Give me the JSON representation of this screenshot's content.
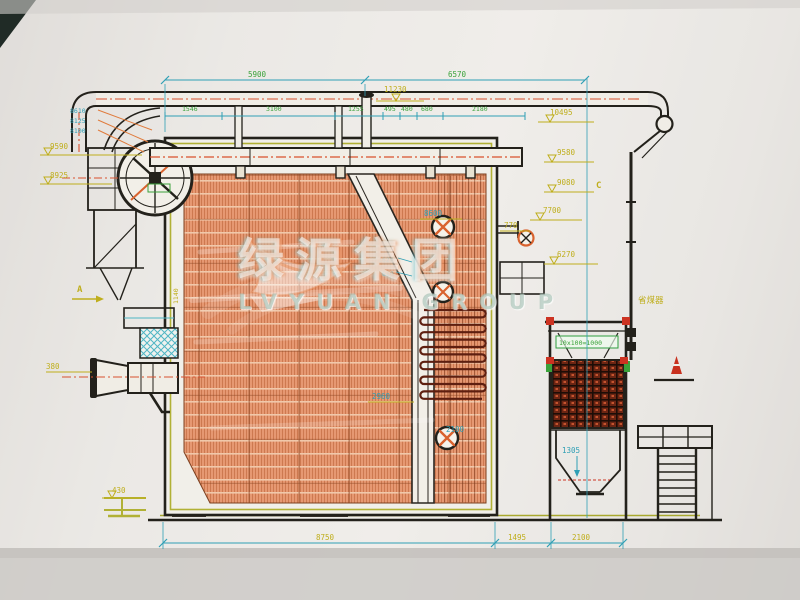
{
  "watermark": {
    "cn": "绿源集团",
    "en": "LVYUAN GROUP"
  },
  "markers": {
    "a": "A",
    "c": "C",
    "equipment": "省煤器"
  },
  "colors": {
    "paper": "#efede9",
    "ink": "#23211b",
    "furnace_hatch": "#e59770",
    "dim_cyan": "#2f9fb5",
    "dim_green": "#3aa23a",
    "dim_yellow": "#bfae1c",
    "centerline_red": "#d9512e",
    "structure_olive": "#a8a82e"
  },
  "dims_top": {
    "span_left": "5900",
    "span_right": "6570",
    "vent_elev": "11230",
    "row": [
      "1546",
      "3100",
      "1255",
      "495",
      "480",
      "680",
      "2180"
    ]
  },
  "elev_left": {
    "pipe1": "8610",
    "pipe2": "8125",
    "pipe3": "8100",
    "platform": "9590",
    "lower": "8925"
  },
  "elev_right": {
    "r1": "10495",
    "r2": "9580",
    "r3": "9080",
    "r4": "7700",
    "r5": "6270"
  },
  "dims_mid": {
    "target_top": "8600",
    "stub": "770",
    "duct_a": "1620",
    "duct_b": "610",
    "width": "2960",
    "rear": "2100",
    "left_v": "1140",
    "burner": "380",
    "base": "430",
    "hopper": "1305",
    "econ_pitch": "10x100=1000"
  },
  "dims_bottom": {
    "b1": "8750",
    "b2": "1495",
    "b3": "2100"
  }
}
